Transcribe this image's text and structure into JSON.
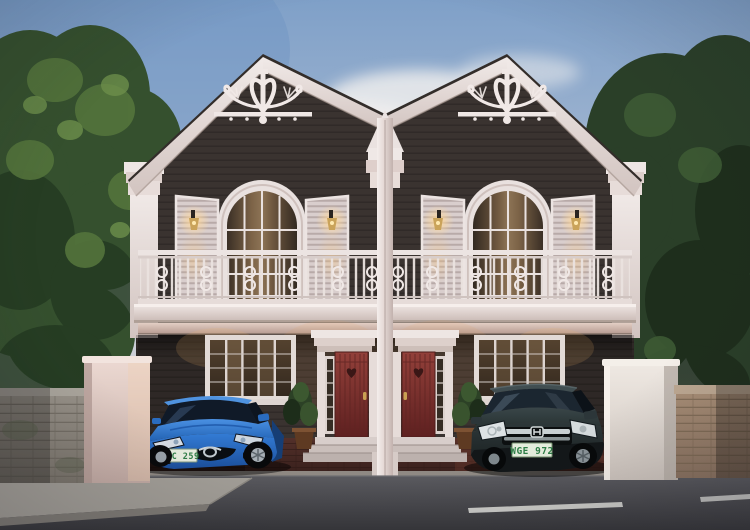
{
  "scene": {
    "type": "architectural-render",
    "description": "Dusk street view of a symmetrical two-storey duplex house with ornate white Victorian gable trim, arched shuttered windows, a white wrought-iron balcony, two red entry doors, a blue sedan and a dark SUV parked in twin carports, flanked by trees and boundary walls."
  },
  "house": {
    "storeys": 2,
    "units": 2,
    "features": [
      "twin gables with gingerbread scroll ornament",
      "arched french windows with louvered shutters",
      "lit wall sconces",
      "white balcony railing with scrollwork",
      "red panel doors with heart wreath",
      "white door surrounds and steps",
      "brick paver driveways",
      "potted plants"
    ]
  },
  "vehicles": {
    "sedan": {
      "color_name": "blue",
      "position": "left carport",
      "plate": "MIC 259"
    },
    "suv": {
      "color_name": "dark gray",
      "position": "right carport",
      "plate": "WGE 972"
    }
  },
  "palette": {
    "sky_top": "#7fa0c8",
    "sky_horizon": "#e0d9d6",
    "siding": "#3a3330",
    "trim_white": "#eae1de",
    "roof_edge": "#2f2a27",
    "door_red": "#8e3a36",
    "driveway_brick": "#4a2b25",
    "road_asphalt": "#4a4a4e",
    "foliage_left": "#3b5731",
    "foliage_right": "#2a3f28",
    "sedan_blue": "#2e79cf",
    "suv_gray": "#303b3e",
    "plate_bg": "#e8eee0",
    "plate_text_color": "#2e7d46"
  }
}
